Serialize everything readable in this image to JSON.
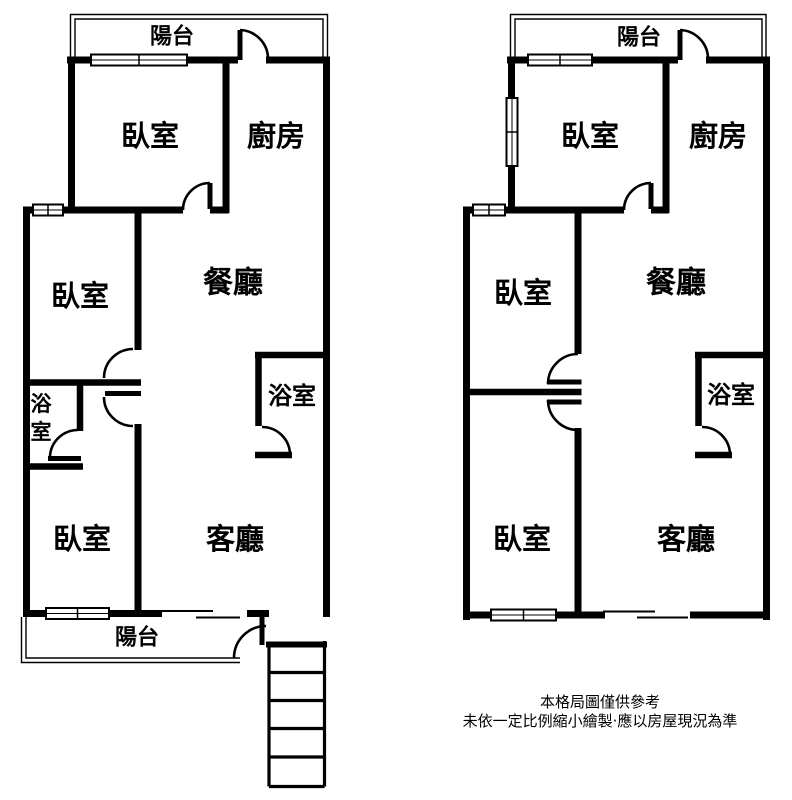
{
  "colors": {
    "wall": "#000000",
    "background": "#ffffff",
    "text": "#000000"
  },
  "left_unit": {
    "balcony_top": "陽台",
    "bedroom_top": "臥室",
    "kitchen": "廚房",
    "bedroom_middle": "臥室",
    "dining": "餐廳",
    "bathroom_small_char_1": "浴",
    "bathroom_small_char_2": "室",
    "bedroom_bottom": "臥室",
    "bathroom_right": "浴室",
    "living": "客廳",
    "balcony_bottom": "陽台"
  },
  "right_unit": {
    "balcony_top": "陽台",
    "bedroom_top": "臥室",
    "kitchen": "廚房",
    "bedroom_middle": "臥室",
    "dining": "餐廳",
    "bedroom_bottom": "臥室",
    "bathroom": "浴室",
    "living": "客廳"
  },
  "disclaimer": {
    "line1": "本格局圖僅供參考",
    "line2": "未依一定比例縮小繪製·應以房屋現況為準"
  }
}
